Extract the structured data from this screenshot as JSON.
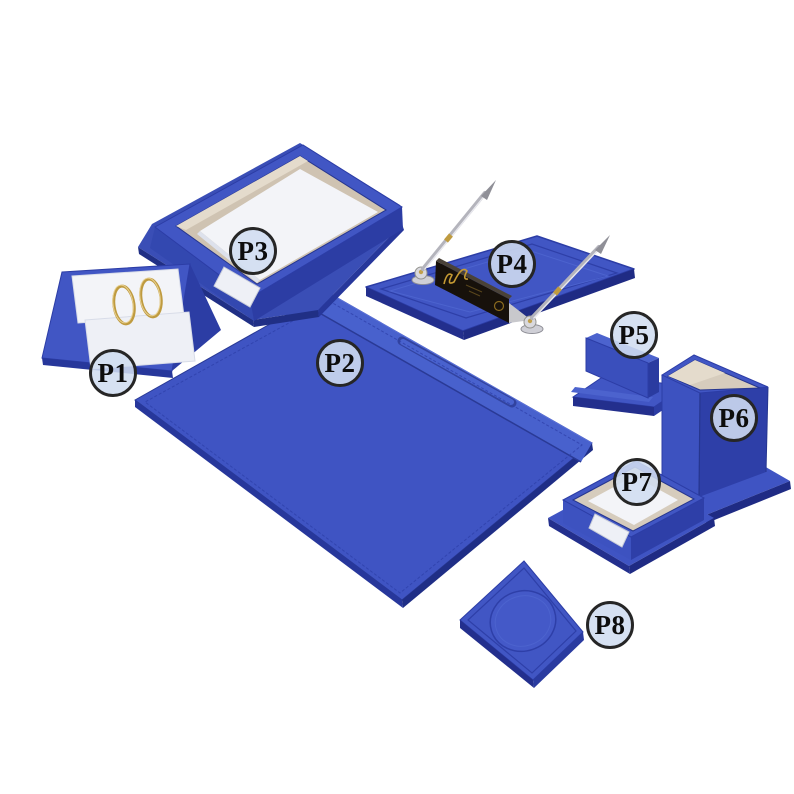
{
  "photo": {
    "kind": "product-photo",
    "subject": "blue leather 8-piece desk organizer set on white background",
    "background": "#ffffff"
  },
  "colors": {
    "leather_blue_top": "#4156c4",
    "leather_blue_mid": "#3a4fbc",
    "leather_blue_dark": "#2c3da4",
    "leather_blue_edge": "#232f8d",
    "flap_blue_light": "#4c63ce",
    "interior_cream": "#d6ccbd",
    "paper_white": "#f3f4f8",
    "metal_silver": "#b4b4bc",
    "metal_gold": "#bf9b40",
    "nameplate_black": "#17110b",
    "label_fill": "#d0ddf0",
    "label_border": "#262626"
  },
  "products": [
    {
      "label": "P1",
      "name": "calendar-ring-stand",
      "piece": "sloped stand with two white cards and two gold binder rings"
    },
    {
      "label": "P2",
      "name": "desk-pad-blotter",
      "piece": "large desk pad with top flap seam and pen groove"
    },
    {
      "label": "P3",
      "name": "document-tray",
      "piece": "paper tray with cream interior, white paper stack and front thumb notch"
    },
    {
      "label": "P4",
      "name": "double-pen-stand",
      "piece": "pen base with two metal pens and black brand nameplate"
    },
    {
      "label": "P5",
      "name": "business-card-holder",
      "piece": "card holder with upright back wall on base plate"
    },
    {
      "label": "P6",
      "name": "pencil-cup",
      "piece": "tall square pen cup with cream lining on flanged base"
    },
    {
      "label": "P7",
      "name": "memo-paper-holder",
      "piece": "square memo box with white note paper on flanged base"
    },
    {
      "label": "P8",
      "name": "coaster",
      "piece": "square coaster with embossed circle"
    }
  ]
}
